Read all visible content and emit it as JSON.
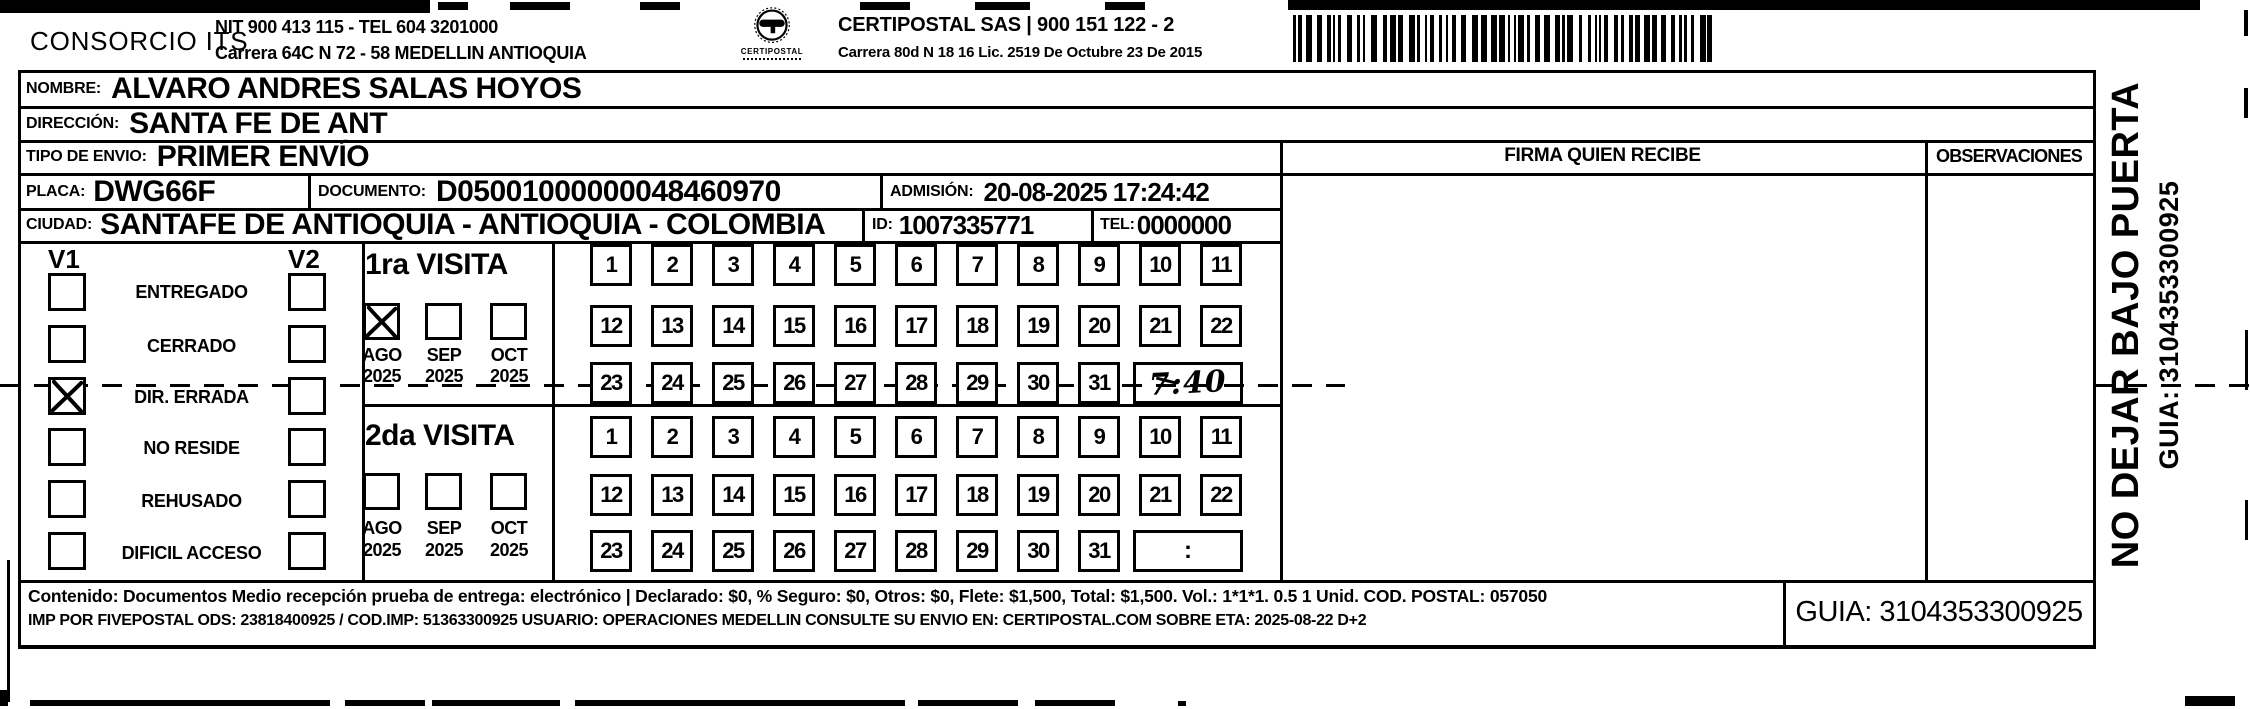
{
  "header": {
    "company_name": "CONSORCIO ITS",
    "company_nit_tel": "NIT 900 413 115 - TEL 604 3201000",
    "company_address": "Carrera 64C N 72 - 58 MEDELLIN ANTIOQUIA",
    "logo_caption": "CERTIPOSTAL",
    "carrier_name_nit": "CERTIPOSTAL SAS | 900 151 122 - 2",
    "carrier_address_lic": "Carrera 80d N 18 16  Lic. 2519 De Octubre 23 De 2015"
  },
  "shipment": {
    "nombre_label": "NOMBRE:",
    "nombre_value": "ALVARO ANDRES SALAS HOYOS",
    "direccion_label": "DIRECCIÓN:",
    "direccion_value": "SANTA FE DE ANT",
    "tipo_envio_label": "TIPO DE ENVIO:",
    "tipo_envio_value": "PRIMER ENVÍO",
    "placa_label": "PLACA:",
    "placa_value": "DWG66F",
    "documento_label": "DOCUMENTO:",
    "documento_value": "D05001000000048460970",
    "admision_label": "ADMISIÓN:",
    "admision_value": "20-08-2025 17:24:42",
    "ciudad_label": "CIUDAD:",
    "ciudad_value": "SANTAFE DE ANTIOQUIA - ANTIOQUIA - COLOMBIA",
    "id_label": "ID:",
    "id_value": "1007335771",
    "tel_label": "TEL:",
    "tel_value": "0000000"
  },
  "table_headers": {
    "firma": "FIRMA QUIEN RECIBE",
    "observaciones": "OBSERVACIONES"
  },
  "delivery_status": {
    "v1_header": "V1",
    "v2_header": "V2",
    "options": [
      {
        "label": "ENTREGADO",
        "v1_checked": false,
        "v2_checked": false
      },
      {
        "label": "CERRADO",
        "v1_checked": false,
        "v2_checked": false
      },
      {
        "label": "DIR. ERRADA",
        "v1_checked": true,
        "v2_checked": false
      },
      {
        "label": "NO RESIDE",
        "v1_checked": false,
        "v2_checked": false
      },
      {
        "label": "REHUSADO",
        "v1_checked": false,
        "v2_checked": false
      },
      {
        "label": "DIFICIL ACCESO",
        "v1_checked": false,
        "v2_checked": false
      }
    ]
  },
  "visits": [
    {
      "title": "1ra VISITA",
      "months": [
        {
          "month": "AGO",
          "year": "2025",
          "checked": true
        },
        {
          "month": "SEP",
          "year": "2025",
          "checked": false
        },
        {
          "month": "OCT",
          "year": "2025",
          "checked": false
        }
      ],
      "days": [
        "1",
        "2",
        "3",
        "4",
        "5",
        "6",
        "7",
        "8",
        "9",
        "10",
        "11",
        "12",
        "13",
        "14",
        "15",
        "16",
        "17",
        "18",
        "19",
        "20",
        "21",
        "22",
        "23",
        "24",
        "25",
        "26",
        "27",
        "28",
        "29",
        "30",
        "31"
      ],
      "marked_day": "21",
      "time_value": "7:40"
    },
    {
      "title": "2da VISITA",
      "months": [
        {
          "month": "AGO",
          "year": "2025",
          "checked": false
        },
        {
          "month": "SEP",
          "year": "2025",
          "checked": false
        },
        {
          "month": "OCT",
          "year": "2025",
          "checked": false
        }
      ],
      "days": [
        "1",
        "2",
        "3",
        "4",
        "5",
        "6",
        "7",
        "8",
        "9",
        "10",
        "11",
        "12",
        "13",
        "14",
        "15",
        "16",
        "17",
        "18",
        "19",
        "20",
        "21",
        "22",
        "23",
        "24",
        "25",
        "26",
        "27",
        "28",
        "29",
        "30",
        "31"
      ],
      "marked_day": "",
      "time_value": ":"
    }
  ],
  "footer": {
    "line1": "Contenido: Documentos Medio recepción prueba de entrega: electrónico | Declarado: $0, % Seguro: $0, Otros: $0, Flete: $1,500, Total: $1,500. Vol.: 1*1*1. 0.5  1 Unid. COD. POSTAL: 057050",
    "line2": "IMP POR FIVEPOSTAL ODS: 23818400925 / COD.IMP: 51363300925 USUARIO: OPERACIONES MEDELLIN CONSULTE SU ENVIO EN: CERTIPOSTAL.COM SOBRE ETA: 2025-08-22 D+2",
    "guia_box": "GUIA: 3104353300925"
  },
  "side_margin": {
    "warning": "NO DEJAR BAJO PUERTA",
    "guia": "GUIA: 3104353300925"
  },
  "colors": {
    "ink": "#000000",
    "paper": "#ffffff"
  }
}
